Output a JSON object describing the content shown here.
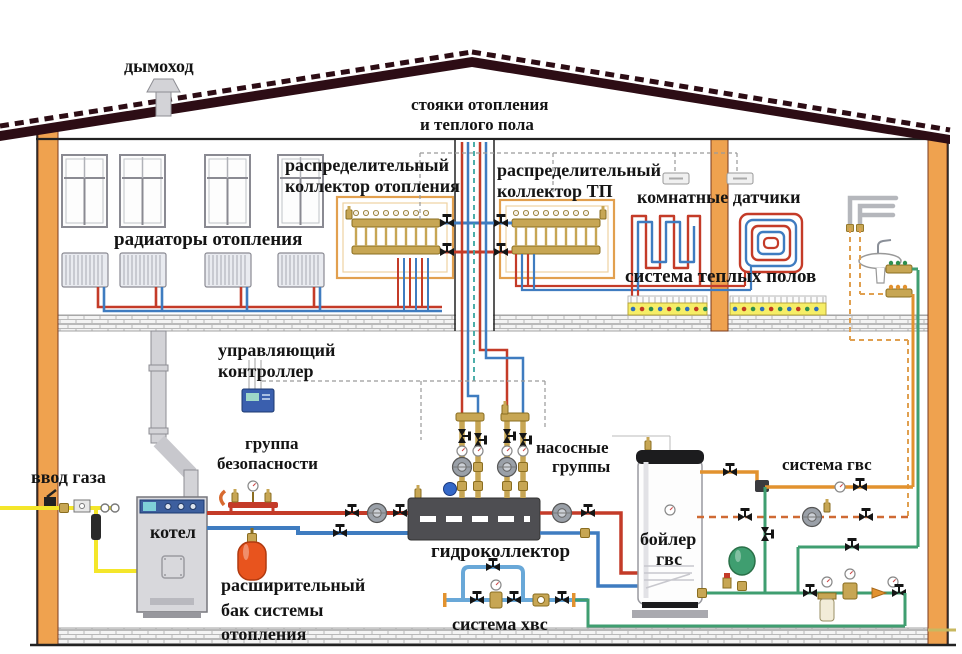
{
  "labels": {
    "chimney": "дымоход",
    "risers1": "стояки отопления",
    "risers2": "и теплого пола",
    "manifold_heating1": "распределительный",
    "manifold_heating2": "коллектор отопления",
    "manifold_ufh1": "распределительный",
    "manifold_ufh2": "коллектор ТП",
    "room_sensors": "комнатные датчики",
    "radiators": "радиаторы отопления",
    "ufh_system": "система теплых полов",
    "controller1": "управляющий",
    "controller2": "контроллер",
    "safety1": "группа",
    "safety2": "безопасности",
    "gas_inlet": "ввод газа",
    "boiler": "котел",
    "pumps1": "насосные",
    "pumps2": "группы",
    "hydro_collector": "гидроколлектор",
    "exp_tank1": "расширительный",
    "exp_tank2": "бак системы",
    "exp_tank3": "отопления",
    "dhw_boiler1": "бойлер",
    "dhw_boiler2": "гвс",
    "dhw_system": "система гвс",
    "cws_system": "система хвс"
  },
  "colors": {
    "heat_supply": "#c43b28",
    "heat_return": "#3f7cc0",
    "cold_water": "#69a8d8",
    "water_green": "#3f9e70",
    "dhw": "#e2922f",
    "dhw_dash": "#e0a050",
    "gas": "#f4e62a",
    "wall": "#efa24f",
    "roof": "#2d0d15",
    "brass": "#c7a654"
  }
}
